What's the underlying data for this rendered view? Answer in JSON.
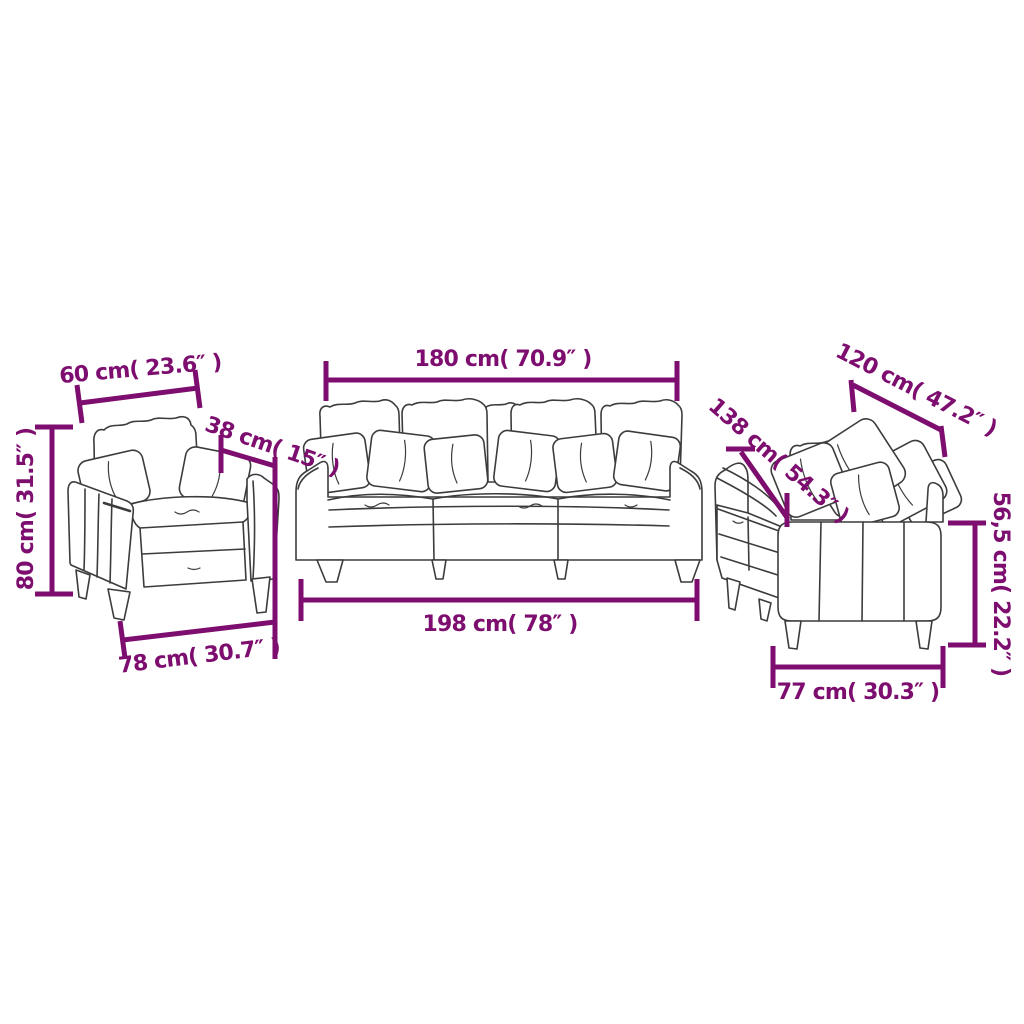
{
  "colors": {
    "dimension": "#7D0D6E",
    "outline": "#3C3C3C"
  },
  "pieces": {
    "armchair": {
      "top_width_label": "60 cm( 23.6″ )",
      "depth_label": "38 cm( 15″ )",
      "height_label": "80 cm( 31.5″ )",
      "bottom_width_label": "78 cm( 30.7″ )"
    },
    "three_seater": {
      "top_width_label": "180 cm( 70.9″ )",
      "bottom_width_label": "198 cm( 78″ )"
    },
    "two_seater": {
      "top_width_label": "120 cm( 47.2″ )",
      "depth_label": "138 cm( 54.3″ )",
      "height_label": "56,5 cm( 22.2″ )",
      "bottom_width_label": "77 cm( 30.3″ )"
    }
  }
}
